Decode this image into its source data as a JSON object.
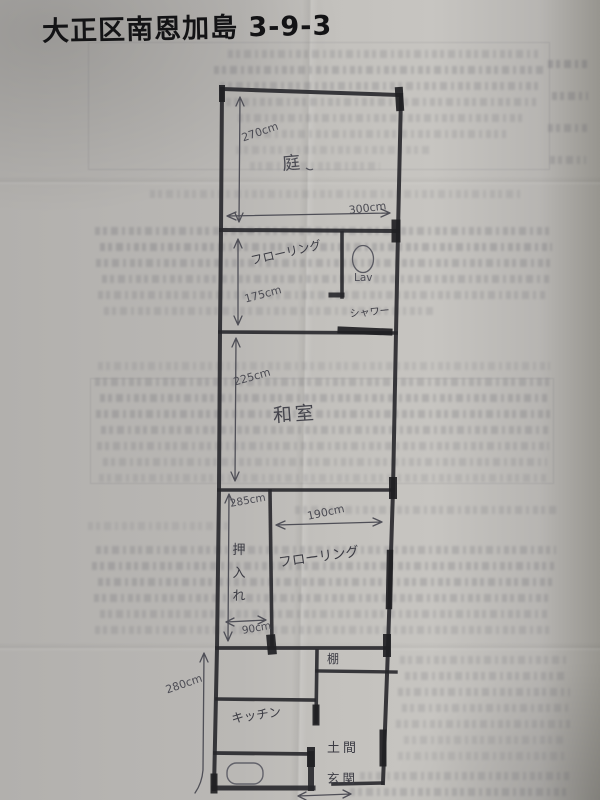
{
  "title": "大正区南恩加島 3-9-3",
  "floorplan": {
    "rooms": {
      "niwa": "庭",
      "flooring_upper": "フローリング",
      "lav": "Lav",
      "shower": "シャワー",
      "washitsu": "和室",
      "oshiire_chars": [
        "押",
        "入",
        "れ"
      ],
      "flooring_lower": "フローリング",
      "tana": "棚",
      "kitchen": "キッチン",
      "doma": "土間",
      "genkan": "玄関"
    },
    "dimensions": {
      "niwa_height": "270cm",
      "niwa_width": "300cm",
      "flooring_upper_height": "175cm",
      "washitsu_height": "225cm",
      "lower_section_height": "285cm",
      "flooring_lower_width": "190cm",
      "oshiire_width": "90cm",
      "bottom_section_height": "280cm"
    }
  },
  "colors": {
    "ink": "#232326",
    "pencil": "#4c4c54",
    "paper": "#c0beba"
  }
}
